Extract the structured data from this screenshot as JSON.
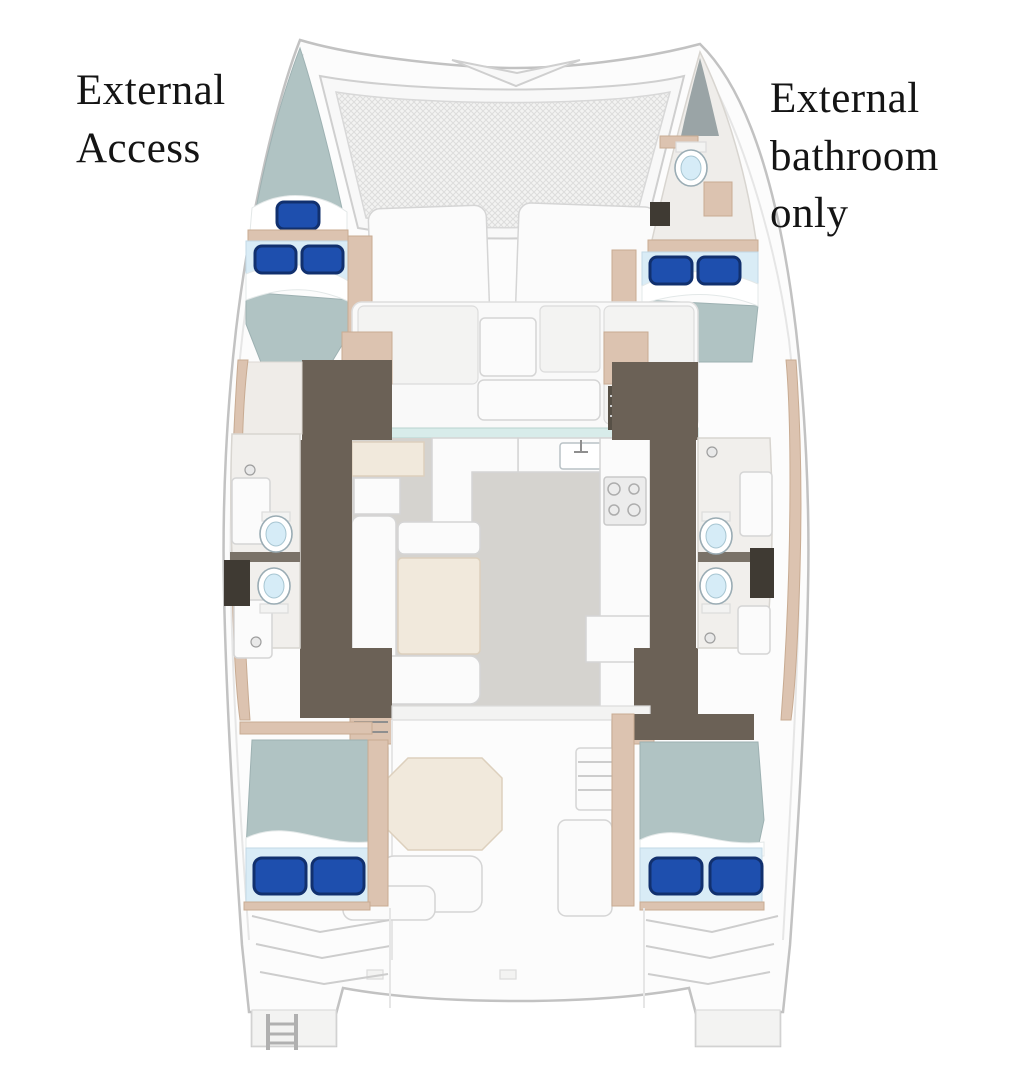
{
  "annotations": {
    "left": "External Access",
    "right": "External bathroom only"
  },
  "colors": {
    "background": "#ffffff",
    "text": "#141414",
    "hull_fill": "#fcfcfc",
    "hull_stroke": "#c2c2c2",
    "bed_mattress": "#b0c3c3",
    "bed_foot": "#d9ecf6",
    "pillow": "#1e4fae",
    "pillow_dark": "#11306e",
    "wood_floor": "#6b6156",
    "trim_tan": "#dcc3b0",
    "saloon_floor": "#d5d3cf",
    "window_glass": "#d8ecea",
    "table_beige": "#f1e9dc"
  }
}
